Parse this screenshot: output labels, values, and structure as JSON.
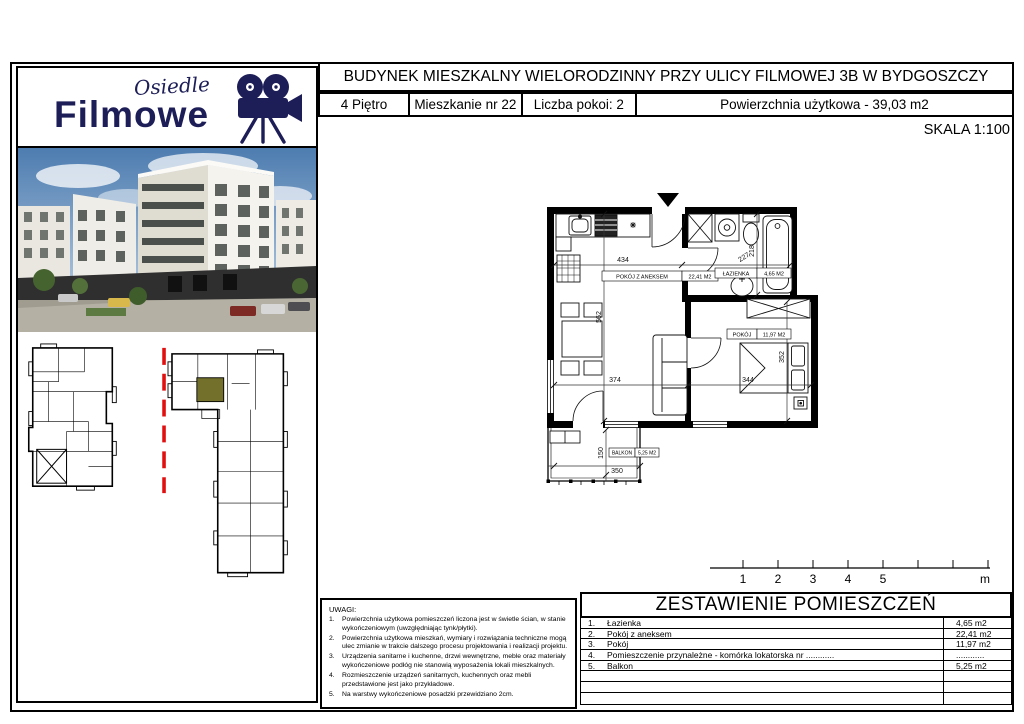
{
  "header": {
    "title": "BUDYNEK MIESZKALNY WIELORODZINNY PRZY ULICY FILMOWEJ 3B W BYDGOSZCZY",
    "cells": [
      "4 Piętro",
      "Mieszkanie nr 22",
      "Liczba pokoi: 2",
      "Powierzchnia użytkowa - 39,03 m2"
    ]
  },
  "logo": {
    "script": "Osiedle",
    "name": "Filmowe"
  },
  "scale_label": "SKALA 1:100",
  "plan": {
    "rooms": [
      {
        "name": "POKÓJ Z ANEKSEM",
        "area": "22,41 M2"
      },
      {
        "name": "ŁAZIENKA",
        "area": "4,65 M2"
      },
      {
        "name": "POKÓJ",
        "area": "11,97 M2"
      },
      {
        "name": "BALKON",
        "area": "5,25 M2"
      }
    ],
    "dims": [
      "434",
      "227",
      "218",
      "562",
      "374",
      "344",
      "352",
      "150",
      "350"
    ]
  },
  "scalebar": {
    "labels": [
      "1",
      "2",
      "3",
      "4",
      "5"
    ],
    "unit": "m"
  },
  "uwagi": {
    "title": "UWAGI:",
    "items": [
      {
        "no": "1.",
        "text": "Powierzchnia użytkowa pomieszczeń liczona jest w świetle ścian, w stanie wykończeniowym (uwzględniając tynk/płytki)."
      },
      {
        "no": "2.",
        "text": "Powierzchnia użytkowa mieszkań, wymiary i rozwiązania techniczne mogą ulec zmianie w trakcie dalszego procesu projektowania i realizacji projektu."
      },
      {
        "no": "3.",
        "text": "Urządzenia sanitarne i kuchenne, drzwi wewnętrzne, meble oraz materiały wykończeniowe podłóg nie stanowią wyposażenia lokali mieszkalnych."
      },
      {
        "no": "4.",
        "text": "Rozmieszczenie urządzeń sanitarnych, kuchennych oraz mebli przedstawione jest jako przykładowe."
      },
      {
        "no": "5.",
        "text": "Na warstwy wykończeniowe posadzki przewidziano 2cm."
      }
    ]
  },
  "rooms_table": {
    "title": "ZESTAWIENIE POMIESZCZEŃ",
    "rows": [
      {
        "no": "1.",
        "name": "Łazienka",
        "area": "4,65 m2"
      },
      {
        "no": "2.",
        "name": "Pokój z aneksem",
        "area": "22,41 m2"
      },
      {
        "no": "3.",
        "name": "Pokój",
        "area": "11,97 m2"
      },
      {
        "no": "4.",
        "name": "Pomieszczenie przynależne - komórka lokatorska nr ............",
        "area": "............"
      },
      {
        "no": "5.",
        "name": "Balkon",
        "area": "5,25 m2"
      },
      {
        "no": "",
        "name": "",
        "area": ""
      },
      {
        "no": "",
        "name": "",
        "area": ""
      },
      {
        "no": "",
        "name": "",
        "area": ""
      }
    ]
  },
  "colors": {
    "logo_navy": "#1d1d57",
    "unit_highlight": "#72702a",
    "section_line_red": "#e01010"
  }
}
